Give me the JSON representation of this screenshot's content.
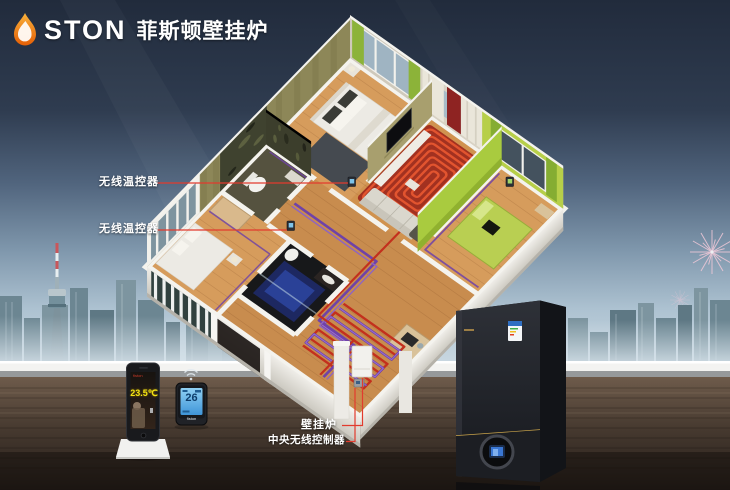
{
  "brand": {
    "logo_text": "STON",
    "logo_icon": "flame-icon",
    "product_title_cn": "菲斯顿壁挂炉"
  },
  "callouts": {
    "wireless_thermostat_1": {
      "label": "无线温控器"
    },
    "wireless_thermostat_2": {
      "label": "无线温控器"
    },
    "boiler": {
      "label": "壁挂炉"
    },
    "central_controller": {
      "label": "中央无线控制器"
    }
  },
  "devices": {
    "phone": {
      "display_temp": "23.5℃",
      "brand": "fiston"
    },
    "wall_thermostat": {
      "display_temp": "26",
      "brand": "fiston",
      "icon": "wireless-signal-icon"
    }
  },
  "scene": {
    "background": "evening-city-skyline",
    "landmark_icons": [
      "tv-tower-icon",
      "fireworks-icon"
    ],
    "apartment": "3d-cutaway-floorplan-with-underfloor-heating",
    "colors": {
      "sky_top": "#212b3c",
      "sky_horizon": "#cbd9e2",
      "pipe_red": "#c3301d",
      "pipe_purple": "#6f42a8",
      "callout_line_red": "#e23b2e",
      "floor_wood": "#c88c4e",
      "wall_olive": "#8d8758",
      "wall_lime": "#a9cb3f",
      "ledge_white": "#f3f3f1",
      "table_wood": "#3a2f27",
      "boiler_body": "#23252b",
      "boiler_gold": "#c9a34a",
      "phone_temp_yellow": "#f2e313",
      "thermostat_lcd_blue": "#5ab2e8"
    }
  }
}
